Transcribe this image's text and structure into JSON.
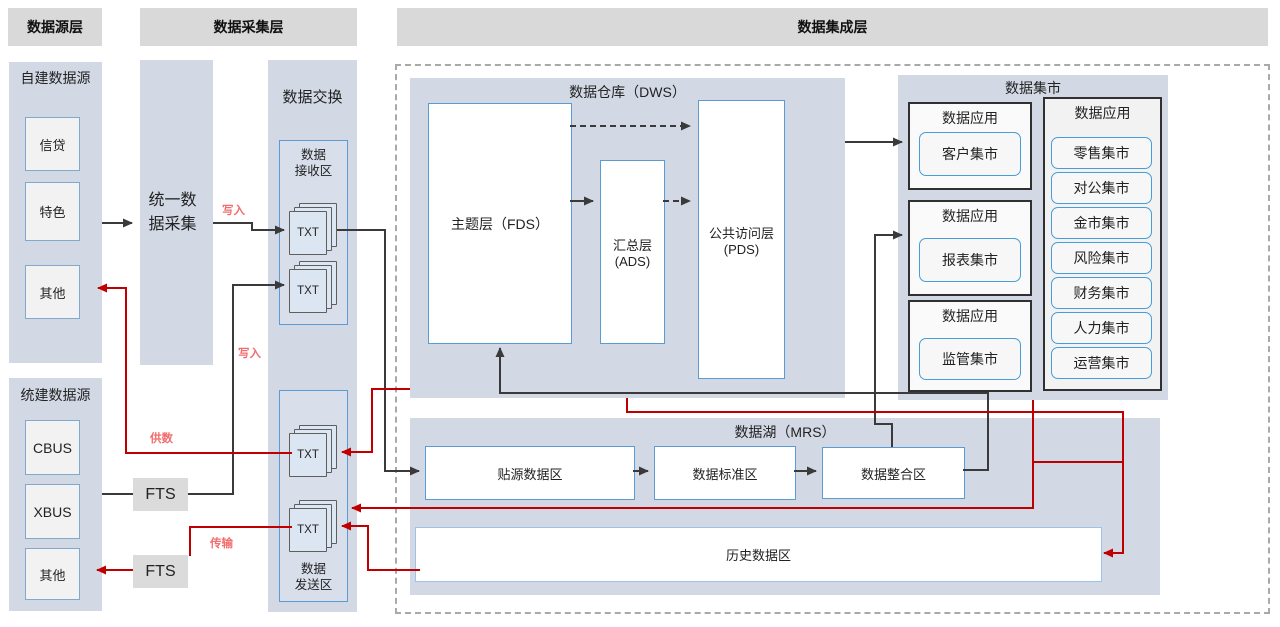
{
  "colors": {
    "header_bg": "#D9D9D9",
    "panel_bg": "#D2D9E5",
    "accent_blue": "#5B9BD5",
    "line_black": "#3A3A3A",
    "line_red": "#C00000",
    "label_red": "#F26D6D",
    "box_gray": "#F2F2F2"
  },
  "headers": {
    "source": "数据源层",
    "collection": "数据采集层",
    "integration": "数据集成层"
  },
  "source": {
    "self_built_title": "自建数据源",
    "self_built_items": [
      "信贷",
      "特色",
      "其他"
    ],
    "unified_title": "统建数据源",
    "unified_items": [
      "CBUS",
      "XBUS",
      "其他"
    ]
  },
  "collection": {
    "unified_collect": "统一数据采集",
    "fts_top": "FTS",
    "fts_bottom": "FTS"
  },
  "exchange": {
    "title": "数据交换",
    "receive_title_line1": "数据",
    "receive_title_line2": "接收区",
    "send_title_line1": "数据",
    "send_title_line2": "发送区",
    "file_label": "TXT"
  },
  "warehouse": {
    "title": "数据仓库（DWS）",
    "fds": "主题层（FDS）",
    "ads_line1": "汇总层",
    "ads_line2": "(ADS)",
    "pds_line1": "公共访问层",
    "pds_line2": "(PDS)"
  },
  "mart": {
    "title": "数据集市",
    "groups": [
      {
        "title": "数据应用",
        "item": "客户集市"
      },
      {
        "title": "数据应用",
        "item": "报表集市"
      },
      {
        "title": "数据应用",
        "item": "监管集市"
      }
    ],
    "apps_title": "数据应用",
    "apps_items": [
      "零售集市",
      "对公集市",
      "金市集市",
      "风险集市",
      "财务集市",
      "人力集市",
      "运营集市"
    ]
  },
  "lake": {
    "title": "数据湖（MRS）",
    "zones": [
      "贴源数据区",
      "数据标准区",
      "数据整合区"
    ],
    "history": "历史数据区"
  },
  "flow_labels": {
    "write_top": "写入",
    "write_bottom": "写入",
    "supply": "供数",
    "transfer": "传输"
  }
}
